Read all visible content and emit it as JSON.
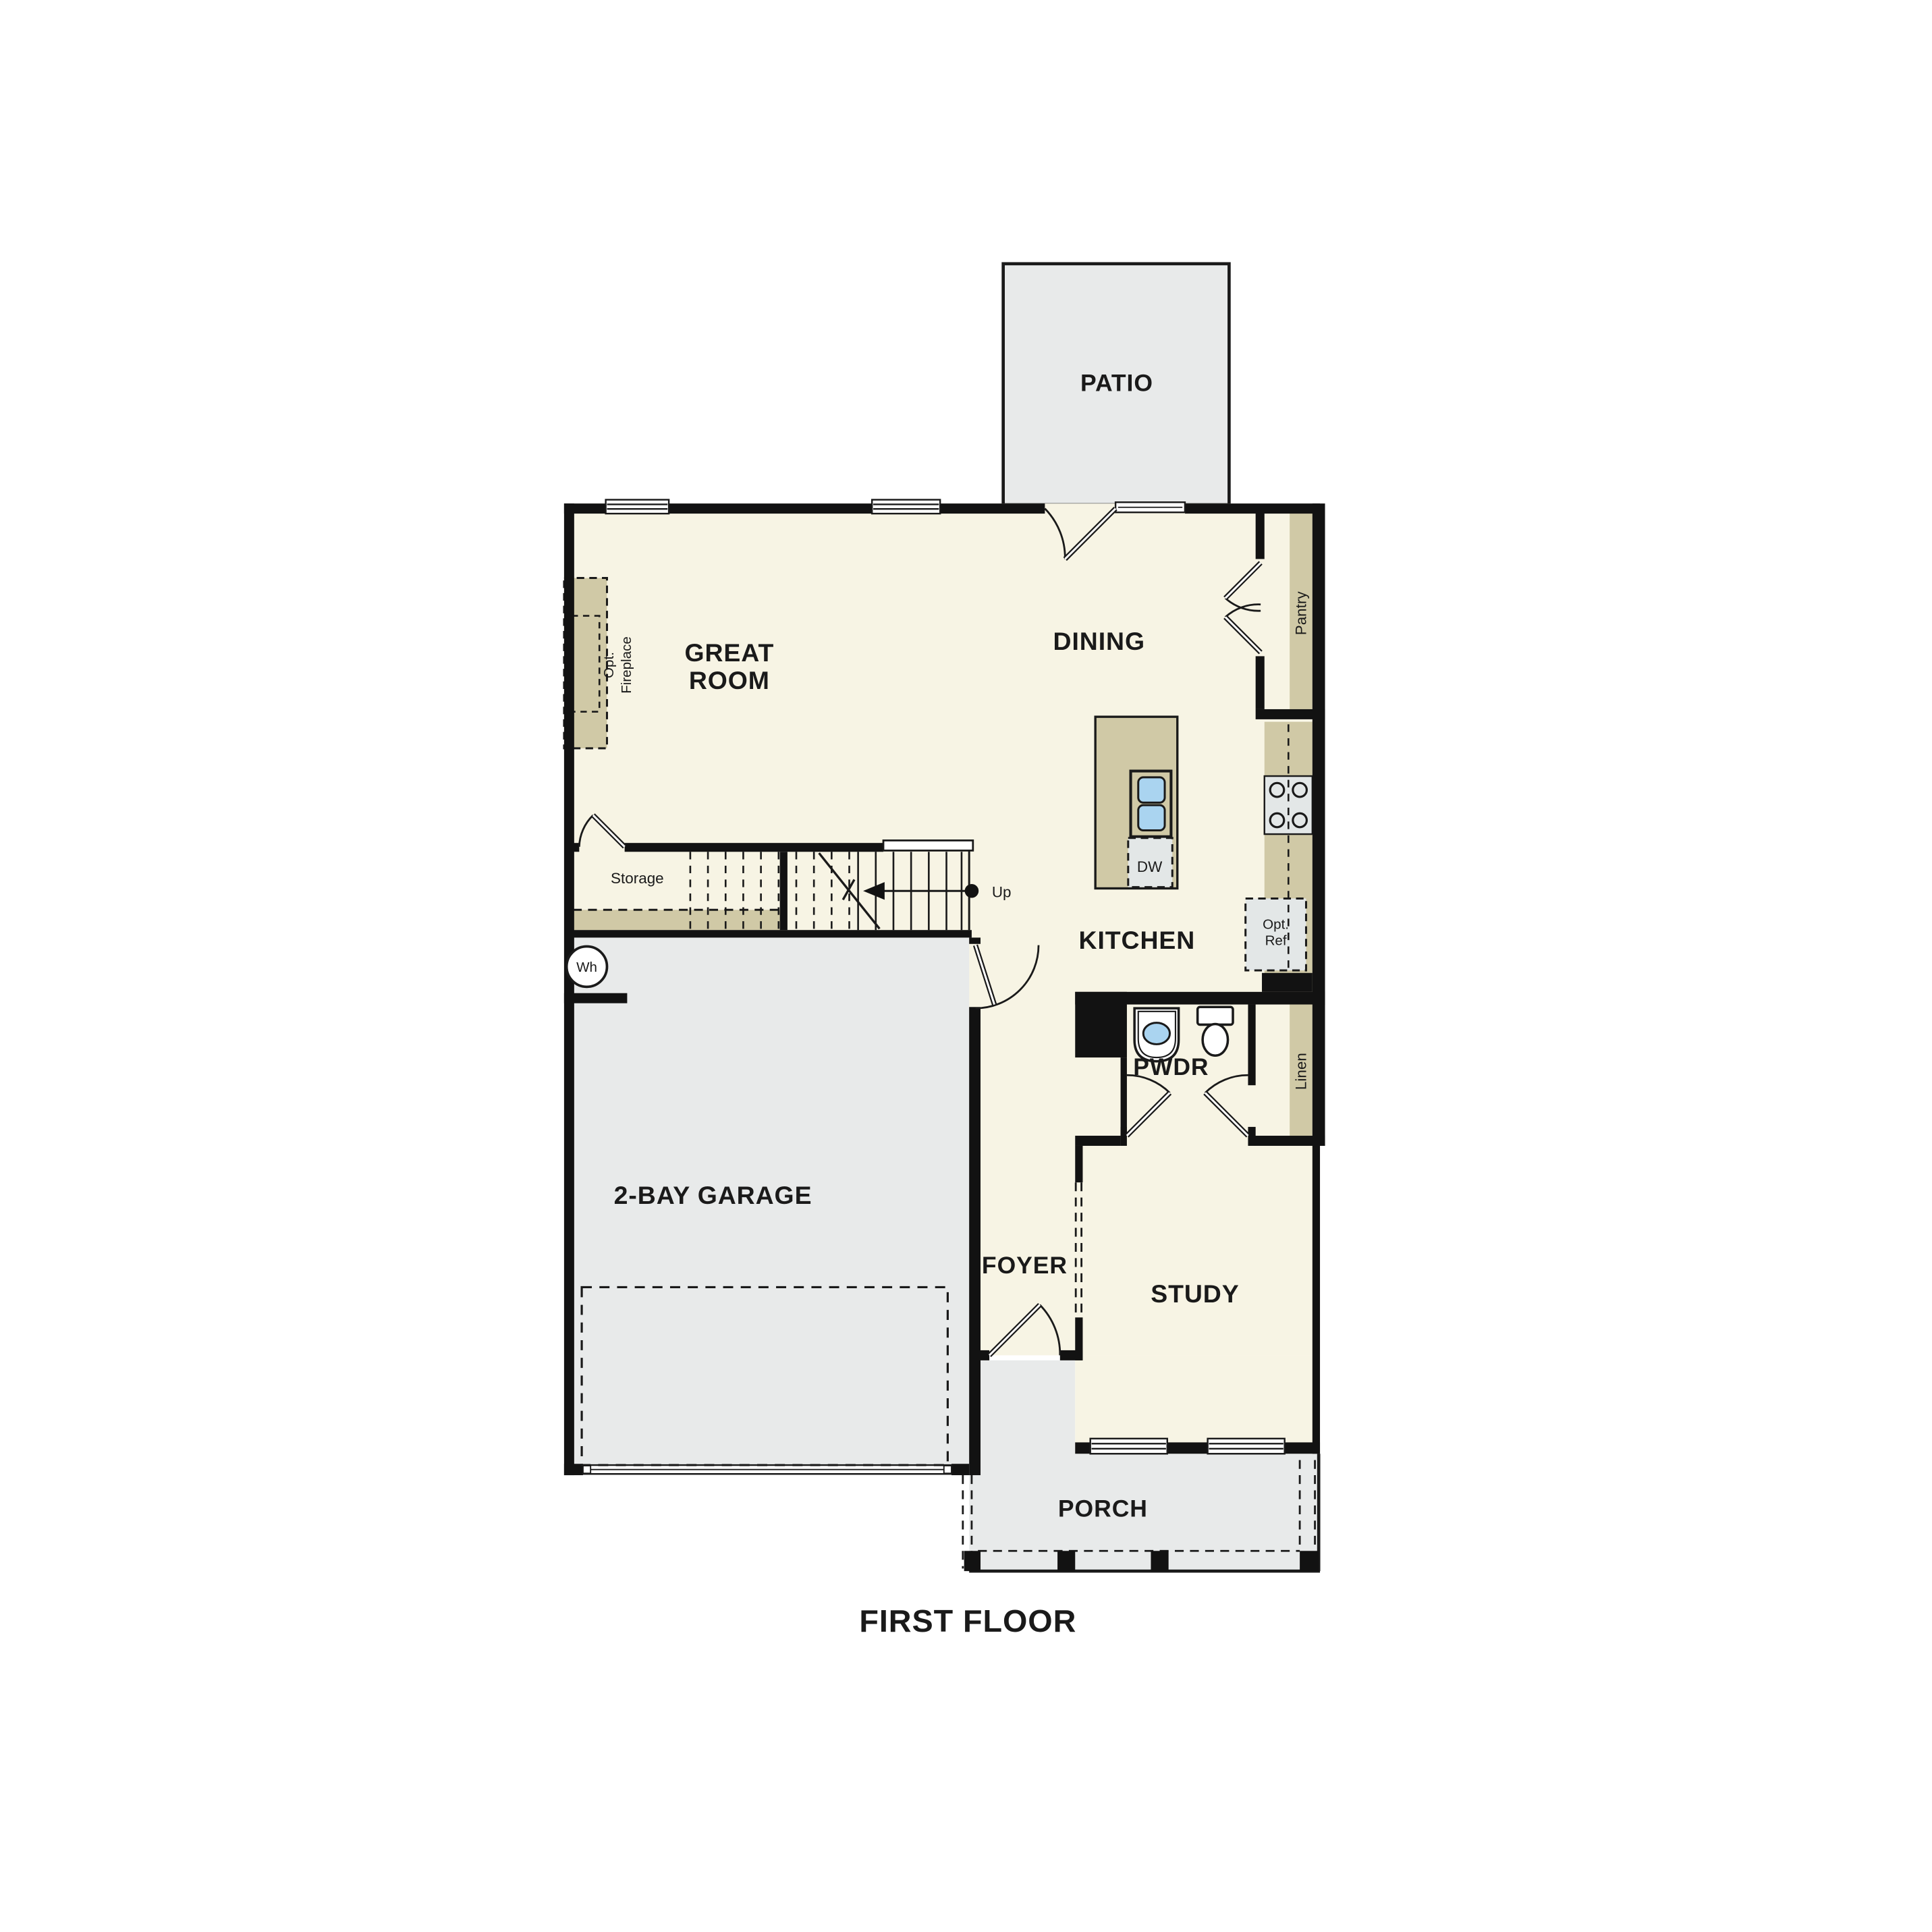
{
  "title": "First floor residential floor plan",
  "floor_label": "FIRST FLOOR",
  "rooms": {
    "patio": {
      "label": "PATIO"
    },
    "great_room": {
      "lines": [
        "GREAT",
        "ROOM"
      ]
    },
    "dining": {
      "label": "DINING"
    },
    "kitchen": {
      "label": "KITCHEN"
    },
    "pantry": {
      "label": "Pantry"
    },
    "storage": {
      "label": "Storage"
    },
    "garage": {
      "label": "2-BAY GARAGE"
    },
    "foyer": {
      "label": "FOYER"
    },
    "pwdr": {
      "label": "PWDR"
    },
    "linen": {
      "label": "Linen"
    },
    "study": {
      "label": "STUDY"
    },
    "porch": {
      "label": "PORCH"
    }
  },
  "features": {
    "opt_fireplace": {
      "lines": [
        "Opt.",
        "Fireplace"
      ]
    },
    "opt_ref": {
      "lines": [
        "Opt.",
        "Ref"
      ]
    },
    "dishwasher": {
      "label": "DW"
    },
    "water_heater": {
      "label": "Wh"
    },
    "stairs_up": {
      "label": "Up"
    }
  },
  "colors": {
    "floor_cream": "#F7F4E4",
    "casework_tan": "#D0C9A6",
    "outdoor_gray": "#E8EAEA",
    "appliance_gray": "#E3E7E7",
    "fixture_blue": "#AAD4F0",
    "wall_black": "#121212",
    "text": "#1A1A1A",
    "background": "#FFFFFF"
  }
}
